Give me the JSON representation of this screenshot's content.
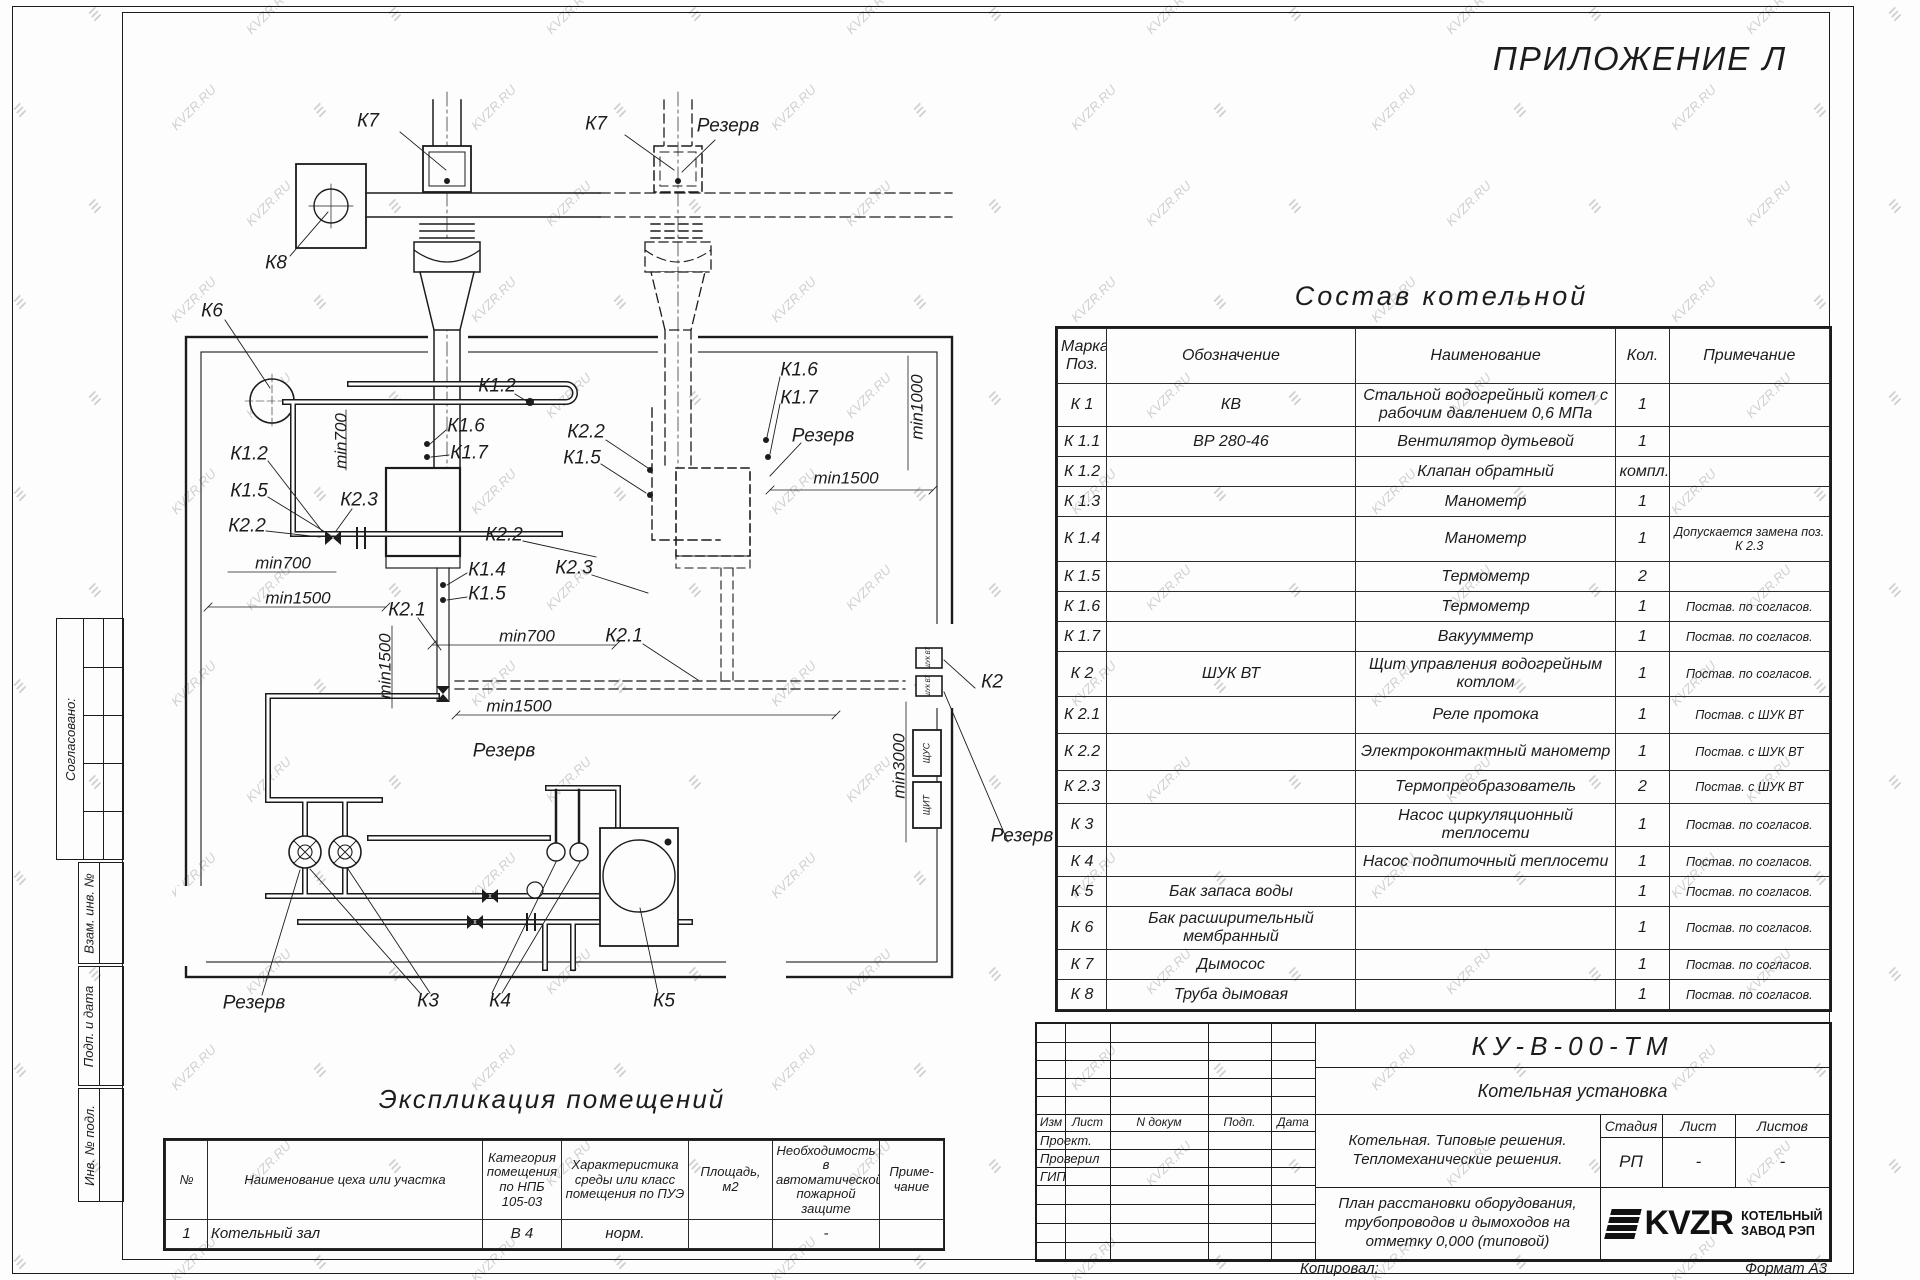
{
  "sheet": {
    "appendix_title": "ПРИЛОЖЕНИЕ Л",
    "copied_label": "Копировал:",
    "format_label": "Формат А3",
    "watermark": {
      "text": "KVZR.RU",
      "glyph": "≡"
    },
    "line_color": "#1c1c1c",
    "watermark_color": "#c6c6c6"
  },
  "side_stamps": [
    "Согласовано:",
    "Взам. инв. №",
    "Подп. и дата",
    "Инв. № подл."
  ],
  "sostav": {
    "title": "Состав котельной",
    "headers": [
      "Марка Поз.",
      "Обозначение",
      "Наименование",
      "Кол.",
      "Примечание"
    ],
    "rows": [
      [
        "К 1",
        "КВ",
        "Стальной водогрейный котел с рабочим давлением  0,6  МПа",
        "1",
        ""
      ],
      [
        "К 1.1",
        "ВР 280-46",
        "Вентилятор дутьевой",
        "1",
        ""
      ],
      [
        "К 1.2",
        "",
        "Клапан обратный",
        "компл.",
        ""
      ],
      [
        "К 1.3",
        "",
        "Манометр",
        "1",
        ""
      ],
      [
        "К 1.4",
        "",
        "Манометр",
        "1",
        "Допускается замена поз. К 2.3"
      ],
      [
        "К 1.5",
        "",
        "Термометр",
        "2",
        ""
      ],
      [
        "К 1.6",
        "",
        "Термометр",
        "1",
        "Постав. по согласов."
      ],
      [
        "К 1.7",
        "",
        "Вакуумметр",
        "1",
        "Постав. по согласов."
      ],
      [
        "К 2",
        "ШУК ВТ",
        "Щит управления водогрейным котлом",
        "1",
        "Постав. по согласов."
      ],
      [
        "К 2.1",
        "",
        "Реле протока",
        "1",
        "Постав. с ШУК ВТ"
      ],
      [
        "К 2.2",
        "",
        "Электроконтактный манометр",
        "1",
        "Постав. с ШУК ВТ"
      ],
      [
        "К 2.3",
        "",
        "Термопреобразователь",
        "2",
        "Постав. с ШУК ВТ"
      ],
      [
        "К 3",
        "",
        "Насос циркуляционный теплосети",
        "1",
        "Постав. по согласов."
      ],
      [
        "К 4",
        "",
        "Насос подпиточный теплосети",
        "1",
        "Постав. по согласов."
      ],
      [
        "К 5",
        "Бак запаса воды",
        "",
        "1",
        "Постав. по согласов."
      ],
      [
        "К 6",
        "Бак расширительный мембранный",
        "",
        "1",
        "Постав. по согласов."
      ],
      [
        "К 7",
        "Дымосос",
        "",
        "1",
        "Постав. по согласов."
      ],
      [
        "К 8",
        "Труба дымовая",
        "",
        "1",
        "Постав. по согласов."
      ]
    ]
  },
  "eksplikacia": {
    "title": "Экспликация помещений",
    "headers": [
      "№",
      "Наименование цеха или участка",
      "Категория помещения по НПБ 105-03",
      "Характеристика среды или класс помещения по ПУЭ",
      "Площадь, м2",
      "Необходимость в автоматической пожарной защите",
      "Приме-\nчание"
    ],
    "rows": [
      [
        "1",
        "Котельный зал",
        "В 4",
        "норм.",
        "",
        "-",
        ""
      ]
    ]
  },
  "title_block": {
    "doc_number": "КУ-В-00-ТМ",
    "object_name": "Котельная установка",
    "description": "Котельная. Типовые решения.\nТепломеханические решения.",
    "sheet_title": "План расстановки оборудования,\nтрубопроводов и дымоходов на\nотметку  0,000  (типовой)",
    "cols": [
      "Изм",
      "Лист",
      "N докум",
      "Подп.",
      "Дата"
    ],
    "roles": [
      "Проект.",
      "Проверил",
      "ГИП"
    ],
    "stage_headers": [
      "Стадия",
      "Лист",
      "Листов"
    ],
    "stage_values": [
      "РП",
      "-",
      "-"
    ],
    "logo_text": "KVZR",
    "logo_caption": "КОТЕЛЬНЫЙ\nЗАВОД РЭП"
  },
  "plan": {
    "labels": [
      {
        "t": "К7",
        "x": 368,
        "y": 121
      },
      {
        "t": "К7",
        "x": 596,
        "y": 124
      },
      {
        "t": "Резерв",
        "x": 728,
        "y": 126
      },
      {
        "t": "К8",
        "x": 276,
        "y": 263
      },
      {
        "t": "К6",
        "x": 212,
        "y": 311
      },
      {
        "t": "К1.2",
        "x": 497,
        "y": 386
      },
      {
        "t": "К1.6",
        "x": 466,
        "y": 426
      },
      {
        "t": "К1.7",
        "x": 469,
        "y": 453
      },
      {
        "t": "К2.2",
        "x": 586,
        "y": 432
      },
      {
        "t": "К1.5",
        "x": 582,
        "y": 458
      },
      {
        "t": "К1.2",
        "x": 249,
        "y": 454
      },
      {
        "t": "К1.5",
        "x": 249,
        "y": 491
      },
      {
        "t": "К2.2",
        "x": 247,
        "y": 526
      },
      {
        "t": "К2.3",
        "x": 359,
        "y": 500
      },
      {
        "t": "min700",
        "x": 341,
        "y": 441,
        "r": -90,
        "s": 17
      },
      {
        "t": "min700",
        "x": 283,
        "y": 563,
        "s": 17
      },
      {
        "t": "min1500",
        "x": 298,
        "y": 598,
        "s": 17
      },
      {
        "t": "К2.1",
        "x": 407,
        "y": 610
      },
      {
        "t": "К1.4",
        "x": 487,
        "y": 570
      },
      {
        "t": "К1.5",
        "x": 487,
        "y": 594
      },
      {
        "t": "min700",
        "x": 527,
        "y": 636,
        "s": 17
      },
      {
        "t": "К2.1",
        "x": 624,
        "y": 636
      },
      {
        "t": "К2.2",
        "x": 504,
        "y": 535
      },
      {
        "t": "К2.3",
        "x": 574,
        "y": 568
      },
      {
        "t": "К1.6",
        "x": 799,
        "y": 370
      },
      {
        "t": "К1.7",
        "x": 799,
        "y": 398
      },
      {
        "t": "Резерв",
        "x": 823,
        "y": 436
      },
      {
        "t": "min1000",
        "x": 917,
        "y": 407,
        "r": -90,
        "s": 17
      },
      {
        "t": "min1500",
        "x": 846,
        "y": 478,
        "s": 17
      },
      {
        "t": "min1500",
        "x": 519,
        "y": 706,
        "s": 17
      },
      {
        "t": "Резерв",
        "x": 504,
        "y": 751
      },
      {
        "t": "min1500",
        "x": 385,
        "y": 666,
        "r": -90,
        "s": 17
      },
      {
        "t": "min3000",
        "x": 899,
        "y": 766,
        "r": -90,
        "s": 17
      },
      {
        "t": "К2",
        "x": 992,
        "y": 682
      },
      {
        "t": "Резерв",
        "x": 1022,
        "y": 836
      },
      {
        "t": "Резерв",
        "x": 254,
        "y": 1003
      },
      {
        "t": "К3",
        "x": 428,
        "y": 1001
      },
      {
        "t": "К4",
        "x": 500,
        "y": 1001
      },
      {
        "t": "К5",
        "x": 664,
        "y": 1001
      },
      {
        "t": "ШУК ВТ",
        "x": 929,
        "y": 658,
        "r": -90,
        "s": 6
      },
      {
        "t": "ШУК ВТ",
        "x": 929,
        "y": 686,
        "r": -90,
        "s": 6
      },
      {
        "t": "ЩУС",
        "x": 927,
        "y": 753,
        "r": -90,
        "s": 9
      },
      {
        "t": "ЩИТ",
        "x": 927,
        "y": 805,
        "r": -90,
        "s": 9
      }
    ]
  }
}
